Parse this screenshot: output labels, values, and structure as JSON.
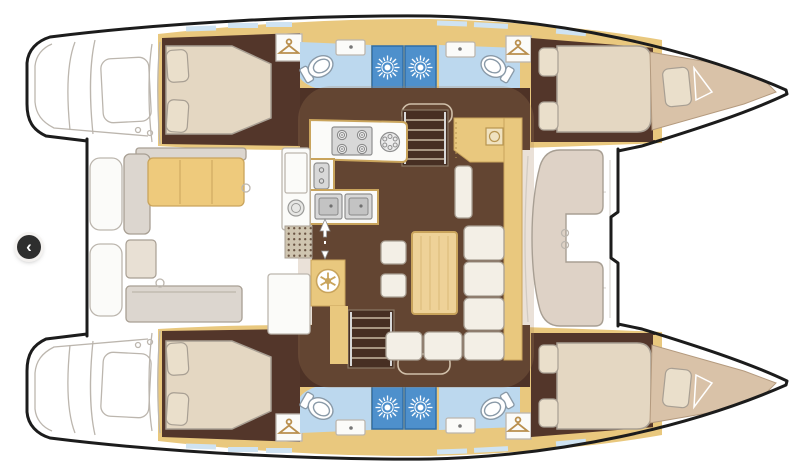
{
  "carousel": {
    "prev_button_glyph": "‹"
  },
  "colors": {
    "outline": "#1c1c1c",
    "wood": "#e9c87e",
    "woodEdge": "#c9a45c",
    "woodLight": "#eed298",
    "floorDark": "#4e3226",
    "floorCabin": "#53362a",
    "bedCream": "#e4d7c2",
    "pillow": "#eadfcb",
    "softEdge": "#a89f93",
    "upholstery": "#f3efe6",
    "bathFloor": "#bcd8ee",
    "showerBlue": "#4e90cc",
    "showerEdge": "#2e6da9",
    "windowBlue": "#cfe3f2",
    "cushionTan": "#eeca7c",
    "benchGrey": "#dcd6cf",
    "lineArt": "#bcb6ae",
    "applianceGrey": "#d8d8d8",
    "forepeak": "#d9c2a8",
    "roofShade": "#a8835c",
    "matBase": "#cfc5b0",
    "matDots": "#6b5544",
    "buttonDark": "#2e2e2e",
    "buttonGlyph": "#ffffff"
  },
  "diagram": {
    "type": "catamaran-floor-plan",
    "hulls": 2,
    "rooms": [
      {
        "name": "aft-cockpit",
        "features": [
          "bench-cushion",
          "grey-benches",
          "transom-steps"
        ]
      },
      {
        "name": "salon",
        "features": [
          "dining-table",
          "l-shaped-sofa",
          "two-stools",
          "nav-cabinet"
        ]
      },
      {
        "name": "galley",
        "features": [
          "four-burner-stove",
          "round-hob",
          "double-sink",
          "fridge-column",
          "threshold-mat",
          "sliding-door-arrows",
          "snowflake-appliance"
        ]
      },
      {
        "name": "port-aft-cabin",
        "features": [
          "double-bed",
          "two-pillows",
          "hanging-locker"
        ]
      },
      {
        "name": "port-aft-head",
        "features": [
          "toilet",
          "sink",
          "shower-stall"
        ]
      },
      {
        "name": "port-forward-head",
        "features": [
          "toilet",
          "sink",
          "shower-stall"
        ]
      },
      {
        "name": "port-forward-cabin",
        "features": [
          "double-bed",
          "two-pillows",
          "hanging-locker"
        ]
      },
      {
        "name": "starboard-aft-cabin",
        "features": [
          "double-bed",
          "two-pillows",
          "hanging-locker"
        ]
      },
      {
        "name": "starboard-aft-head",
        "features": [
          "toilet",
          "sink",
          "shower-stall"
        ]
      },
      {
        "name": "starboard-forward-head",
        "features": [
          "toilet",
          "sink",
          "shower-stall"
        ]
      },
      {
        "name": "starboard-forward-cabin",
        "features": [
          "double-bed",
          "two-pillows",
          "hanging-locker"
        ]
      },
      {
        "name": "forward-cockpit",
        "features": [
          "c-shaped-lounge",
          "deck-hatches"
        ]
      },
      {
        "name": "forepeaks",
        "features": [
          "crew-berth-cushion"
        ]
      }
    ],
    "companionways": 2,
    "icons": [
      "chevron-left-icon",
      "shower-sunburst-icon",
      "toilet-icon",
      "hanger-icon",
      "stove-burner-icon",
      "round-hob-icon",
      "double-sink-icon",
      "snowflake-icon",
      "stairs-icon",
      "sliding-door-arrow-icon",
      "deck-hatch-icon"
    ]
  }
}
